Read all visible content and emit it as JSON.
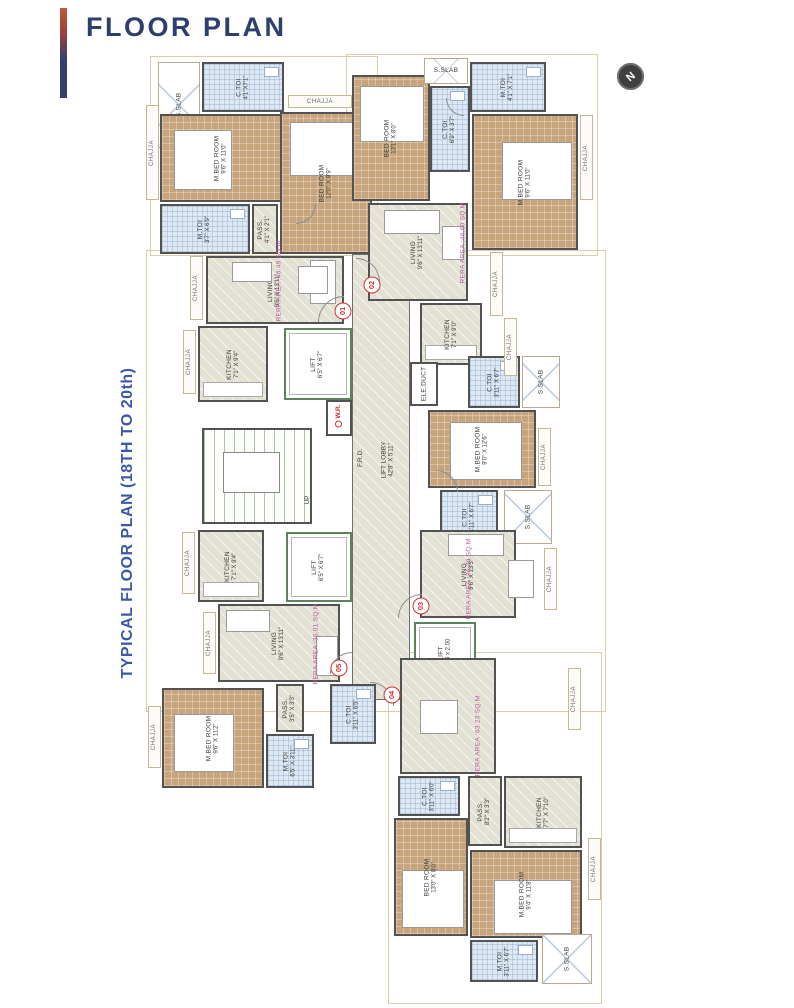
{
  "header": {
    "title": "FLOOR PLAN"
  },
  "sidebar": {
    "title": "TYPICAL FLOOR PLAN (18TH TO 20th)"
  },
  "compass": {
    "label": "N"
  },
  "colors": {
    "accent_navy": "#2d3f6e",
    "side_blue": "#3c59a6",
    "rera_pink": "#b85c9e",
    "unit_red": "#cc3333"
  },
  "plan": {
    "chajja_label": "CHAJJA",
    "outlines": [
      [
        150,
        56,
        228,
        200
      ],
      [
        346,
        54,
        252,
        202
      ],
      [
        146,
        250,
        460,
        462
      ],
      [
        388,
        652,
        214,
        352
      ]
    ],
    "rooms": [
      {
        "type": "lobby",
        "x": 352,
        "y": 254,
        "w": 58,
        "h": 446
      },
      {
        "type": "stair",
        "x": 202,
        "y": 428,
        "w": 110,
        "h": 96
      },
      {
        "type": "shaft",
        "x": 326,
        "y": 400,
        "w": 26,
        "h": 36
      },
      {
        "label": "S.SLAB",
        "type": "slab",
        "x": 158,
        "y": 62,
        "w": 42,
        "h": 86,
        "rot": 1
      },
      {
        "label": "C.TOI",
        "dim": "4'1\"X7'1\"",
        "type": "toilet",
        "x": 202,
        "y": 62,
        "w": 82,
        "h": 50,
        "rot": 1
      },
      {
        "label": "M.BED ROOM",
        "dim": "9'6\" X 11'0\"",
        "type": "bed",
        "x": 160,
        "y": 114,
        "w": 122,
        "h": 88,
        "rot": 1,
        "bed": [
          172,
          128,
          58,
          60
        ]
      },
      {
        "label": "M.TOI",
        "dim": "3'7\" X 6'9\"",
        "type": "toilet",
        "x": 160,
        "y": 204,
        "w": 90,
        "h": 50,
        "rot": 1
      },
      {
        "label": "PASS.",
        "dim": "4'1\" X 2'1\"",
        "type": "pass",
        "x": 252,
        "y": 204,
        "w": 26,
        "h": 50,
        "rot": 1
      },
      {
        "label": "BED ROOM",
        "dim": "12'0\" X 8'9\"",
        "type": "bed",
        "x": 280,
        "y": 112,
        "w": 92,
        "h": 142,
        "rot": 1,
        "bed": [
          288,
          120,
          76,
          54
        ]
      },
      {
        "label": "LIVING",
        "dim": "9'6\" X 13'11\"",
        "type": "living",
        "x": 206,
        "y": 256,
        "w": 138,
        "h": 68,
        "rot": 1
      },
      {
        "label": "KITCHEN",
        "dim": "7'1\" X 9'4\"",
        "type": "kitchen",
        "x": 198,
        "y": 326,
        "w": 70,
        "h": 76,
        "rot": 1
      },
      {
        "label": "LIFT",
        "dim": "6'5\" X 6'7\"",
        "type": "lift",
        "x": 284,
        "y": 328,
        "w": 68,
        "h": 72,
        "rot": 1
      },
      {
        "label": "BED ROOM",
        "dim": "13'1\" X 8'0\"",
        "type": "bed",
        "x": 352,
        "y": 75,
        "w": 78,
        "h": 126,
        "rot": 1,
        "bed": [
          358,
          84,
          64,
          56
        ]
      },
      {
        "label": "S.SLAB",
        "type": "slab",
        "x": 424,
        "y": 58,
        "w": 44,
        "h": 26,
        "rot": 0
      },
      {
        "label": "C.TOI",
        "dim": "6'9\" X 3'7\"",
        "type": "toilet",
        "x": 430,
        "y": 86,
        "w": 40,
        "h": 86,
        "rot": 1
      },
      {
        "label": "M.TOI",
        "dim": "4'1\" X 7'1\"",
        "type": "toilet",
        "x": 470,
        "y": 62,
        "w": 76,
        "h": 50,
        "rot": 1
      },
      {
        "label": "M.BED ROOM",
        "dim": "9'6\" X 11'0\"",
        "type": "bed",
        "x": 472,
        "y": 114,
        "w": 106,
        "h": 136,
        "rot": 1,
        "bed": [
          500,
          140,
          70,
          58
        ]
      },
      {
        "label": "LIVING",
        "dim": "9'6\" X 13'11\"",
        "type": "living",
        "x": 368,
        "y": 203,
        "w": 100,
        "h": 98,
        "rot": 1
      },
      {
        "label": "KITCHEN",
        "dim": "7'1\" X 9'0\"",
        "type": "kitchen",
        "x": 420,
        "y": 303,
        "w": 62,
        "h": 62,
        "rot": 1
      },
      {
        "label": "ELE.DUCT",
        "type": "shaft",
        "x": 410,
        "y": 362,
        "w": 28,
        "h": 44,
        "rot": 1
      },
      {
        "label": "C.TOI",
        "dim": "3'11\" X 6'7\"",
        "type": "toilet",
        "x": 468,
        "y": 356,
        "w": 52,
        "h": 52,
        "rot": 1
      },
      {
        "label": "S.SLAB",
        "type": "slab",
        "x": 522,
        "y": 356,
        "w": 38,
        "h": 52,
        "rot": 1
      },
      {
        "label": "M.BED ROOM",
        "dim": "9'0\" X 12'6\"",
        "type": "bed",
        "x": 428,
        "y": 410,
        "w": 108,
        "h": 78,
        "rot": 1,
        "bed": [
          448,
          420,
          72,
          58
        ]
      },
      {
        "label": "C.TOI",
        "dim": "3'11\" X 6'7\"",
        "type": "toilet",
        "x": 440,
        "y": 490,
        "w": 58,
        "h": 54,
        "rot": 1
      },
      {
        "label": "S.SLAB",
        "type": "slab",
        "x": 504,
        "y": 490,
        "w": 48,
        "h": 54,
        "rot": 1
      },
      {
        "label": "KITCHEN",
        "dim": "7'1\" X 9'4\"",
        "type": "kitchen",
        "x": 198,
        "y": 530,
        "w": 66,
        "h": 72,
        "rot": 1
      },
      {
        "label": "LIFT",
        "dim": "6'5\" X 6'7\"",
        "type": "lift",
        "x": 286,
        "y": 532,
        "w": 66,
        "h": 70,
        "rot": 1
      },
      {
        "label": "LIVING",
        "dim": "9'6\" X 13'11\"",
        "type": "living",
        "x": 218,
        "y": 604,
        "w": 122,
        "h": 78,
        "rot": 1
      },
      {
        "label": "PASS.",
        "dim": "3'5\" X 3'3\"",
        "type": "pass",
        "x": 276,
        "y": 684,
        "w": 28,
        "h": 48,
        "rot": 1
      },
      {
        "label": "M.BED ROOM",
        "dim": "9'6\" X 11'2\"",
        "type": "bed",
        "x": 162,
        "y": 688,
        "w": 102,
        "h": 100,
        "rot": 1,
        "bed": [
          172,
          712,
          60,
          58
        ]
      },
      {
        "label": "M.TOI",
        "dim": "6'5\" X 3'11\"",
        "type": "toilet",
        "x": 266,
        "y": 734,
        "w": 48,
        "h": 54,
        "rot": 1
      },
      {
        "label": "C.TOI",
        "dim": "3'11\" X 6'5\"",
        "type": "toilet",
        "x": 330,
        "y": 684,
        "w": 46,
        "h": 60,
        "rot": 1
      },
      {
        "label": "LIVING",
        "dim": "9'6\" X 13'3\"",
        "type": "living",
        "x": 420,
        "y": 530,
        "w": 96,
        "h": 88,
        "rot": 1
      },
      {
        "label": "LIFT",
        "dim": "1.95 x 2.00",
        "type": "lift",
        "x": 414,
        "y": 622,
        "w": 62,
        "h": 62,
        "rot": 1
      },
      {
        "label": "LIVING",
        "dim": "9'2\" X 18'9\"",
        "type": "living",
        "x": 400,
        "y": 658,
        "w": 96,
        "h": 116,
        "rot": 1
      },
      {
        "label": "C.TOI",
        "dim": "3'11\" X 6'0\"",
        "type": "toilet",
        "x": 398,
        "y": 776,
        "w": 62,
        "h": 40,
        "rot": 1
      },
      {
        "label": "PASS.",
        "dim": "8'2\" X 3'3\"",
        "type": "pass",
        "x": 468,
        "y": 776,
        "w": 34,
        "h": 70,
        "rot": 1
      },
      {
        "label": "KITCHEN",
        "dim": "7'7\" X 7'10\"",
        "type": "kitchen",
        "x": 504,
        "y": 776,
        "w": 78,
        "h": 72,
        "rot": 1
      },
      {
        "label": "BED ROOM",
        "dim": "13'0\" X 8'0\"",
        "type": "bed",
        "x": 394,
        "y": 818,
        "w": 74,
        "h": 118,
        "rot": 1,
        "bed": [
          400,
          868,
          62,
          58
        ]
      },
      {
        "label": "M.BED ROOM",
        "dim": "9'4\" X 11'8\"",
        "type": "bed",
        "x": 470,
        "y": 850,
        "w": 112,
        "h": 88,
        "rot": 1,
        "bed": [
          492,
          878,
          78,
          54
        ]
      },
      {
        "label": "M.TOI",
        "dim": "3'11\" X 6'7\"",
        "type": "toilet",
        "x": 470,
        "y": 940,
        "w": 68,
        "h": 42,
        "rot": 1
      },
      {
        "label": "S.SLAB",
        "type": "slab",
        "x": 542,
        "y": 934,
        "w": 50,
        "h": 50,
        "rot": 1
      }
    ],
    "chajjas": [
      {
        "x": 146,
        "y": 105,
        "w": 13,
        "h": 95
      },
      {
        "x": 288,
        "y": 95,
        "w": 64,
        "h": 13,
        "horiz": 1
      },
      {
        "x": 580,
        "y": 115,
        "w": 13,
        "h": 85
      },
      {
        "x": 190,
        "y": 256,
        "w": 13,
        "h": 64
      },
      {
        "x": 183,
        "y": 330,
        "w": 13,
        "h": 64
      },
      {
        "x": 490,
        "y": 252,
        "w": 13,
        "h": 64
      },
      {
        "x": 504,
        "y": 318,
        "w": 13,
        "h": 58
      },
      {
        "x": 538,
        "y": 428,
        "w": 13,
        "h": 58
      },
      {
        "x": 182,
        "y": 532,
        "w": 13,
        "h": 62
      },
      {
        "x": 203,
        "y": 612,
        "w": 13,
        "h": 62
      },
      {
        "x": 544,
        "y": 548,
        "w": 13,
        "h": 62
      },
      {
        "x": 568,
        "y": 668,
        "w": 13,
        "h": 62
      },
      {
        "x": 588,
        "y": 838,
        "w": 13,
        "h": 62
      },
      {
        "x": 148,
        "y": 706,
        "w": 13,
        "h": 62
      }
    ],
    "furniture": [
      [
        310,
        260,
        26,
        44
      ],
      [
        232,
        262,
        40,
        20
      ],
      [
        298,
        266,
        30,
        28
      ],
      [
        384,
        210,
        56,
        24
      ],
      [
        442,
        226,
        22,
        34
      ],
      [
        226,
        610,
        44,
        22
      ],
      [
        316,
        636,
        22,
        40
      ],
      [
        448,
        534,
        56,
        22
      ],
      [
        420,
        700,
        38,
        34
      ],
      [
        508,
        560,
        26,
        38
      ]
    ],
    "arcs": [
      [
        318,
        296,
        26,
        0
      ],
      [
        356,
        258,
        24,
        90
      ],
      [
        398,
        594,
        24,
        0
      ],
      [
        370,
        682,
        24,
        90
      ],
      [
        330,
        652,
        22,
        0
      ],
      [
        436,
        470,
        22,
        90
      ],
      [
        296,
        204,
        20,
        180
      ],
      [
        446,
        98,
        18,
        270
      ]
    ],
    "texts": [
      {
        "t": "W.R.",
        "x": 339,
        "y": 416,
        "rot": 1,
        "wr": 1
      },
      {
        "t": "F.R.D.",
        "x": 361,
        "y": 458,
        "rot": 1
      },
      {
        "t": "LIFT LOBBY",
        "d": "42'8\" X 5'11\"",
        "x": 388,
        "y": 460,
        "rot": 1
      },
      {
        "t": "UP",
        "x": 308,
        "y": 500,
        "rot": 1
      }
    ],
    "rera_labels": [
      {
        "text": "RERA AREA :46.49 SQ.M",
        "x": 279,
        "y": 281
      },
      {
        "text": "RERA AREA :46.60 SQ.M",
        "x": 463,
        "y": 243
      },
      {
        "text": "RERA AREA :36.30 SQ.M",
        "x": 469,
        "y": 579
      },
      {
        "text": "RERA AREA :63.23 SQ.M",
        "x": 478,
        "y": 736
      },
      {
        "text": "RERA AREA :36.01 SQ.M",
        "x": 316,
        "y": 644
      }
    ],
    "units": [
      {
        "number": "01",
        "x": 343,
        "y": 311
      },
      {
        "number": "02",
        "x": 372,
        "y": 285
      },
      {
        "number": "03",
        "x": 421,
        "y": 606
      },
      {
        "number": "04",
        "x": 392,
        "y": 695
      },
      {
        "number": "05",
        "x": 339,
        "y": 668
      }
    ]
  }
}
